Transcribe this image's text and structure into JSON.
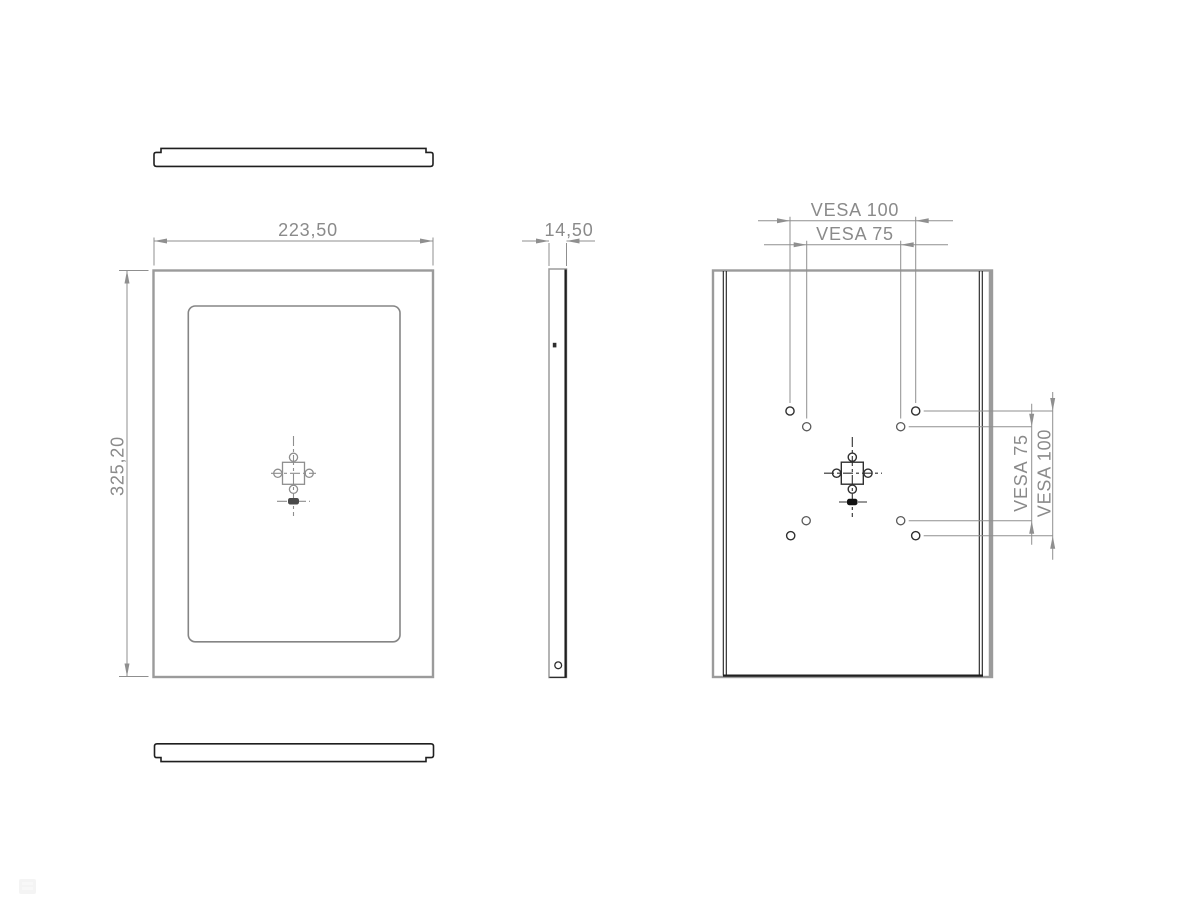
{
  "colors": {
    "background": "#ffffff",
    "object_line": "#9b9b9b",
    "detail_line": "#858585",
    "dark_line": "#1f1f1f",
    "dimension_line": "#8f8f8f",
    "dimension_text": "#8a8a8a"
  },
  "views": {
    "front": {
      "dimensions": {
        "width": "223,50",
        "height": "325,20"
      }
    },
    "side": {
      "dimensions": {
        "depth": "14,50"
      }
    },
    "back": {
      "dimensions": {
        "vesa100_horizontal": "VESA 100",
        "vesa75_horizontal": "VESA 75",
        "vesa75_vertical": "VESA 75",
        "vesa100_vertical": "VESA 100"
      }
    }
  }
}
